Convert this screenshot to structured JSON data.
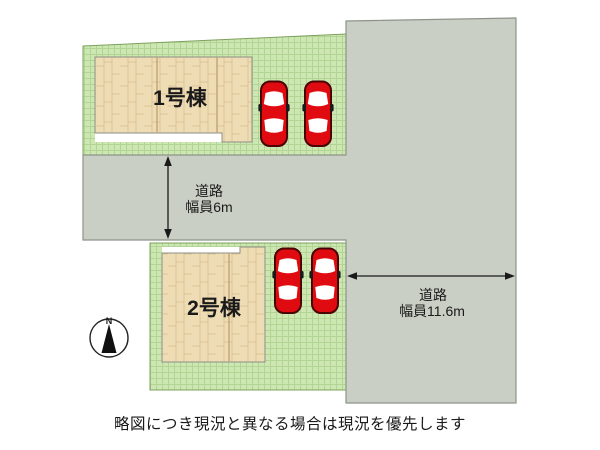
{
  "plan": {
    "caption": "略図につき現況と異なる場合は現況を優先します",
    "lots": {
      "lot1": {
        "building_label": "1号棟",
        "cars_visible": 2
      },
      "lot2": {
        "building_label": "2号棟",
        "cars_visible": 2
      }
    },
    "roads": {
      "horizontal": {
        "name": "道路",
        "width_label": "幅員6m"
      },
      "vertical": {
        "name": "道路",
        "width_label": "幅員11.6m"
      }
    },
    "compass": {
      "label": "N"
    },
    "colors": {
      "background": "#ffffff",
      "grass": "#cde7b2",
      "grass_line": "#b2d494",
      "wood": "#eedcb4",
      "wood_grain": "#ddc497",
      "road": "#cacfc5",
      "road_border": "#8e948a",
      "car_red": "#e00b10",
      "car_outline": "#4a0303",
      "text": "#1a1a1a"
    }
  }
}
